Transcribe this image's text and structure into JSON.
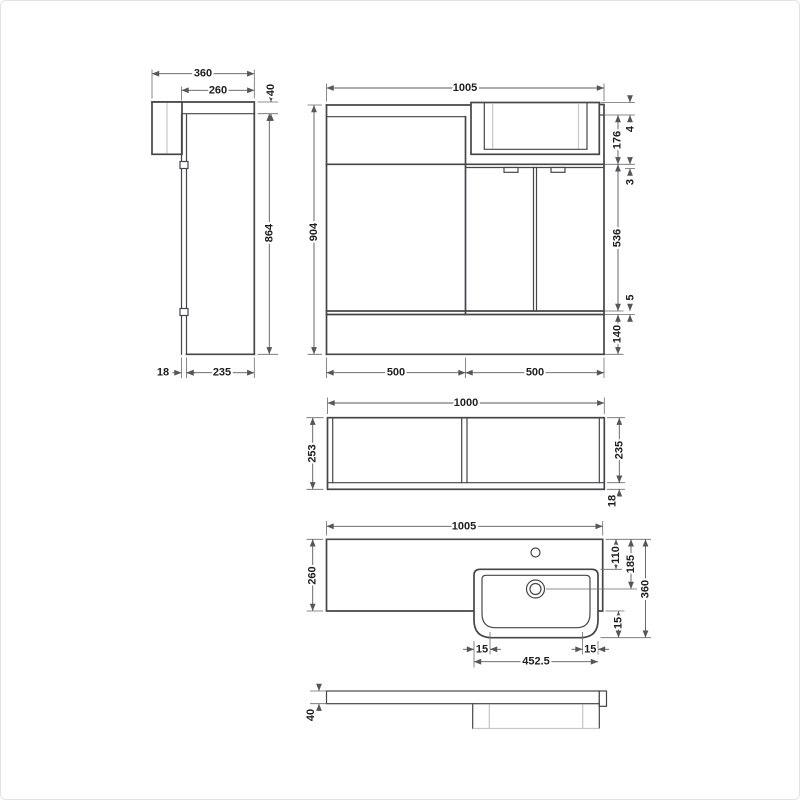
{
  "drawing": {
    "type": "technical-dimension-drawing",
    "subject": "combination vanity / WC furniture unit",
    "views": {
      "side": {
        "overall_depth": "360",
        "worktop_depth": "260",
        "worktop_height": "40",
        "body_height": "864",
        "panel_thickness": "18",
        "body_depth": "235"
      },
      "front": {
        "overall_width": "1005",
        "overall_height": "904",
        "basin_lip": "4",
        "basin_height": "176",
        "gap_basin_door": "3",
        "door_height": "536",
        "gap_door_plinth": "5",
        "plinth_height": "140",
        "left_bay_width": "500",
        "right_bay_width": "500"
      },
      "carcass_plan": {
        "width": "1000",
        "overall_depth": "253",
        "internal_depth": "235",
        "back_panel": "18"
      },
      "worktop_plan": {
        "width": "1005",
        "left_depth": "260",
        "tap_setback": "110",
        "waste_setback": "185",
        "overall_depth": "360",
        "basin_overhang": "15",
        "rim_left": "15",
        "rim_right": "15",
        "bowl_width": "452.5"
      },
      "worktop_profile": {
        "thickness": "40"
      }
    }
  }
}
